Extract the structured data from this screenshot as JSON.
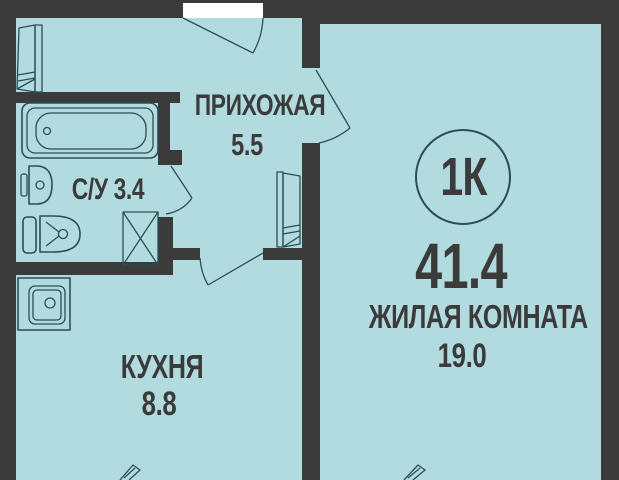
{
  "colors": {
    "wall": "#3b3b3b",
    "floor": "#b2dbdf",
    "line": "#2d4d54",
    "text": "#3b3b3b",
    "openingcolor": "#ffffff"
  },
  "apartment": {
    "type_badge": "1К",
    "total_area": "41.4"
  },
  "rooms": {
    "hallway": {
      "name": "ПРИХОЖАЯ",
      "area": "5.5"
    },
    "bathroom": {
      "name": "С/У",
      "area": "3.4"
    },
    "kitchen": {
      "name": "КУХНЯ",
      "area": "8.8"
    },
    "living": {
      "name": "ЖИЛАЯ КОМНАТА",
      "area": "19.0"
    }
  },
  "icons": {
    "bathtub-icon": "outlined tub with drain circle",
    "washbasin-icon": "rounded basin with drain circle",
    "toilet-icon": "tank and bowl with flush circle",
    "vent-shaft-icon": "square crossed with X",
    "kitchen-sink-icon": "cabinet square with rounded sink and drain",
    "wardrobe-icon": "tall paneled cabinet leaf",
    "door-swing-icon": "door leaf with quarter-circle swing arc",
    "window-flap-icon": "tilted open window flap"
  }
}
